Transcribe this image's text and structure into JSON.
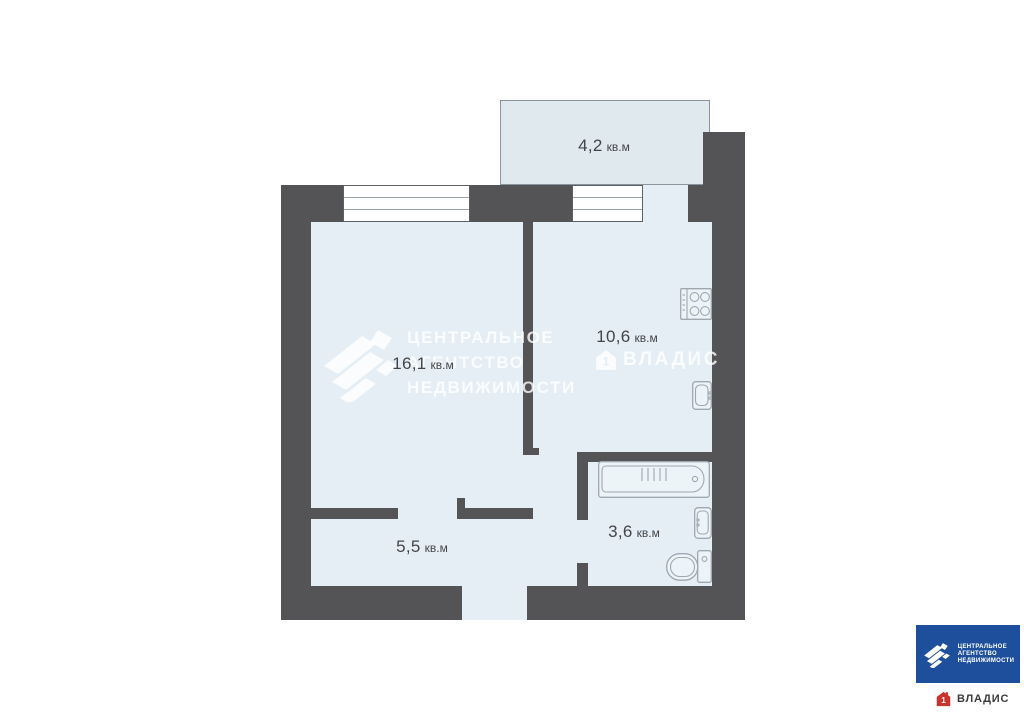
{
  "colors": {
    "page_bg": "#ffffff",
    "wall": "#545457",
    "room_fill": "#e4eef4",
    "balcony_fill": "#dfe9ee",
    "balcony_border": "#8b959d",
    "window_border": "#5d6166",
    "window_line": "#9ca4ab",
    "fixture_line": "#9fa8b1",
    "label_text": "#454548",
    "watermark": "rgba(255,255,255,0.8)",
    "brand_blue": "#1e4f9c",
    "brand_red": "#c9352e",
    "logo_text_dark": "#3c3c3e"
  },
  "rooms": [
    {
      "id": "balcony",
      "area": "4,2",
      "unit": "кв.м"
    },
    {
      "id": "living-room",
      "area": "16,1",
      "unit": "кв.м"
    },
    {
      "id": "kitchen",
      "area": "10,6",
      "unit": "кв.м"
    },
    {
      "id": "hallway",
      "area": "5,5",
      "unit": "кв.м"
    },
    {
      "id": "bathroom",
      "area": "3,6",
      "unit": "кв.м"
    }
  ],
  "watermark": {
    "line1": "ЦЕНТРАЛЬНОЕ",
    "line2": "АГЕНТСТВО",
    "line3": "НЕДВИЖИМОСТИ",
    "brand": "ВЛАДИС"
  },
  "branding": {
    "agency_line1": "ЦЕНТРАЛЬНОЕ",
    "agency_line2": "АГЕНТСТВО",
    "agency_line3": "НЕДВИЖИМОСТИ",
    "vladis_label": "ВЛАДИС",
    "vladis_icon_digit": "1"
  },
  "icons": {
    "stove": "cooktop-4-burners",
    "kitchen_sink": "sink",
    "bathtub": "bath",
    "washbasin": "sink",
    "toilet": "wc",
    "agency_logo": "ribbon-diamond-mark",
    "vladis_house": "house-with-1"
  }
}
